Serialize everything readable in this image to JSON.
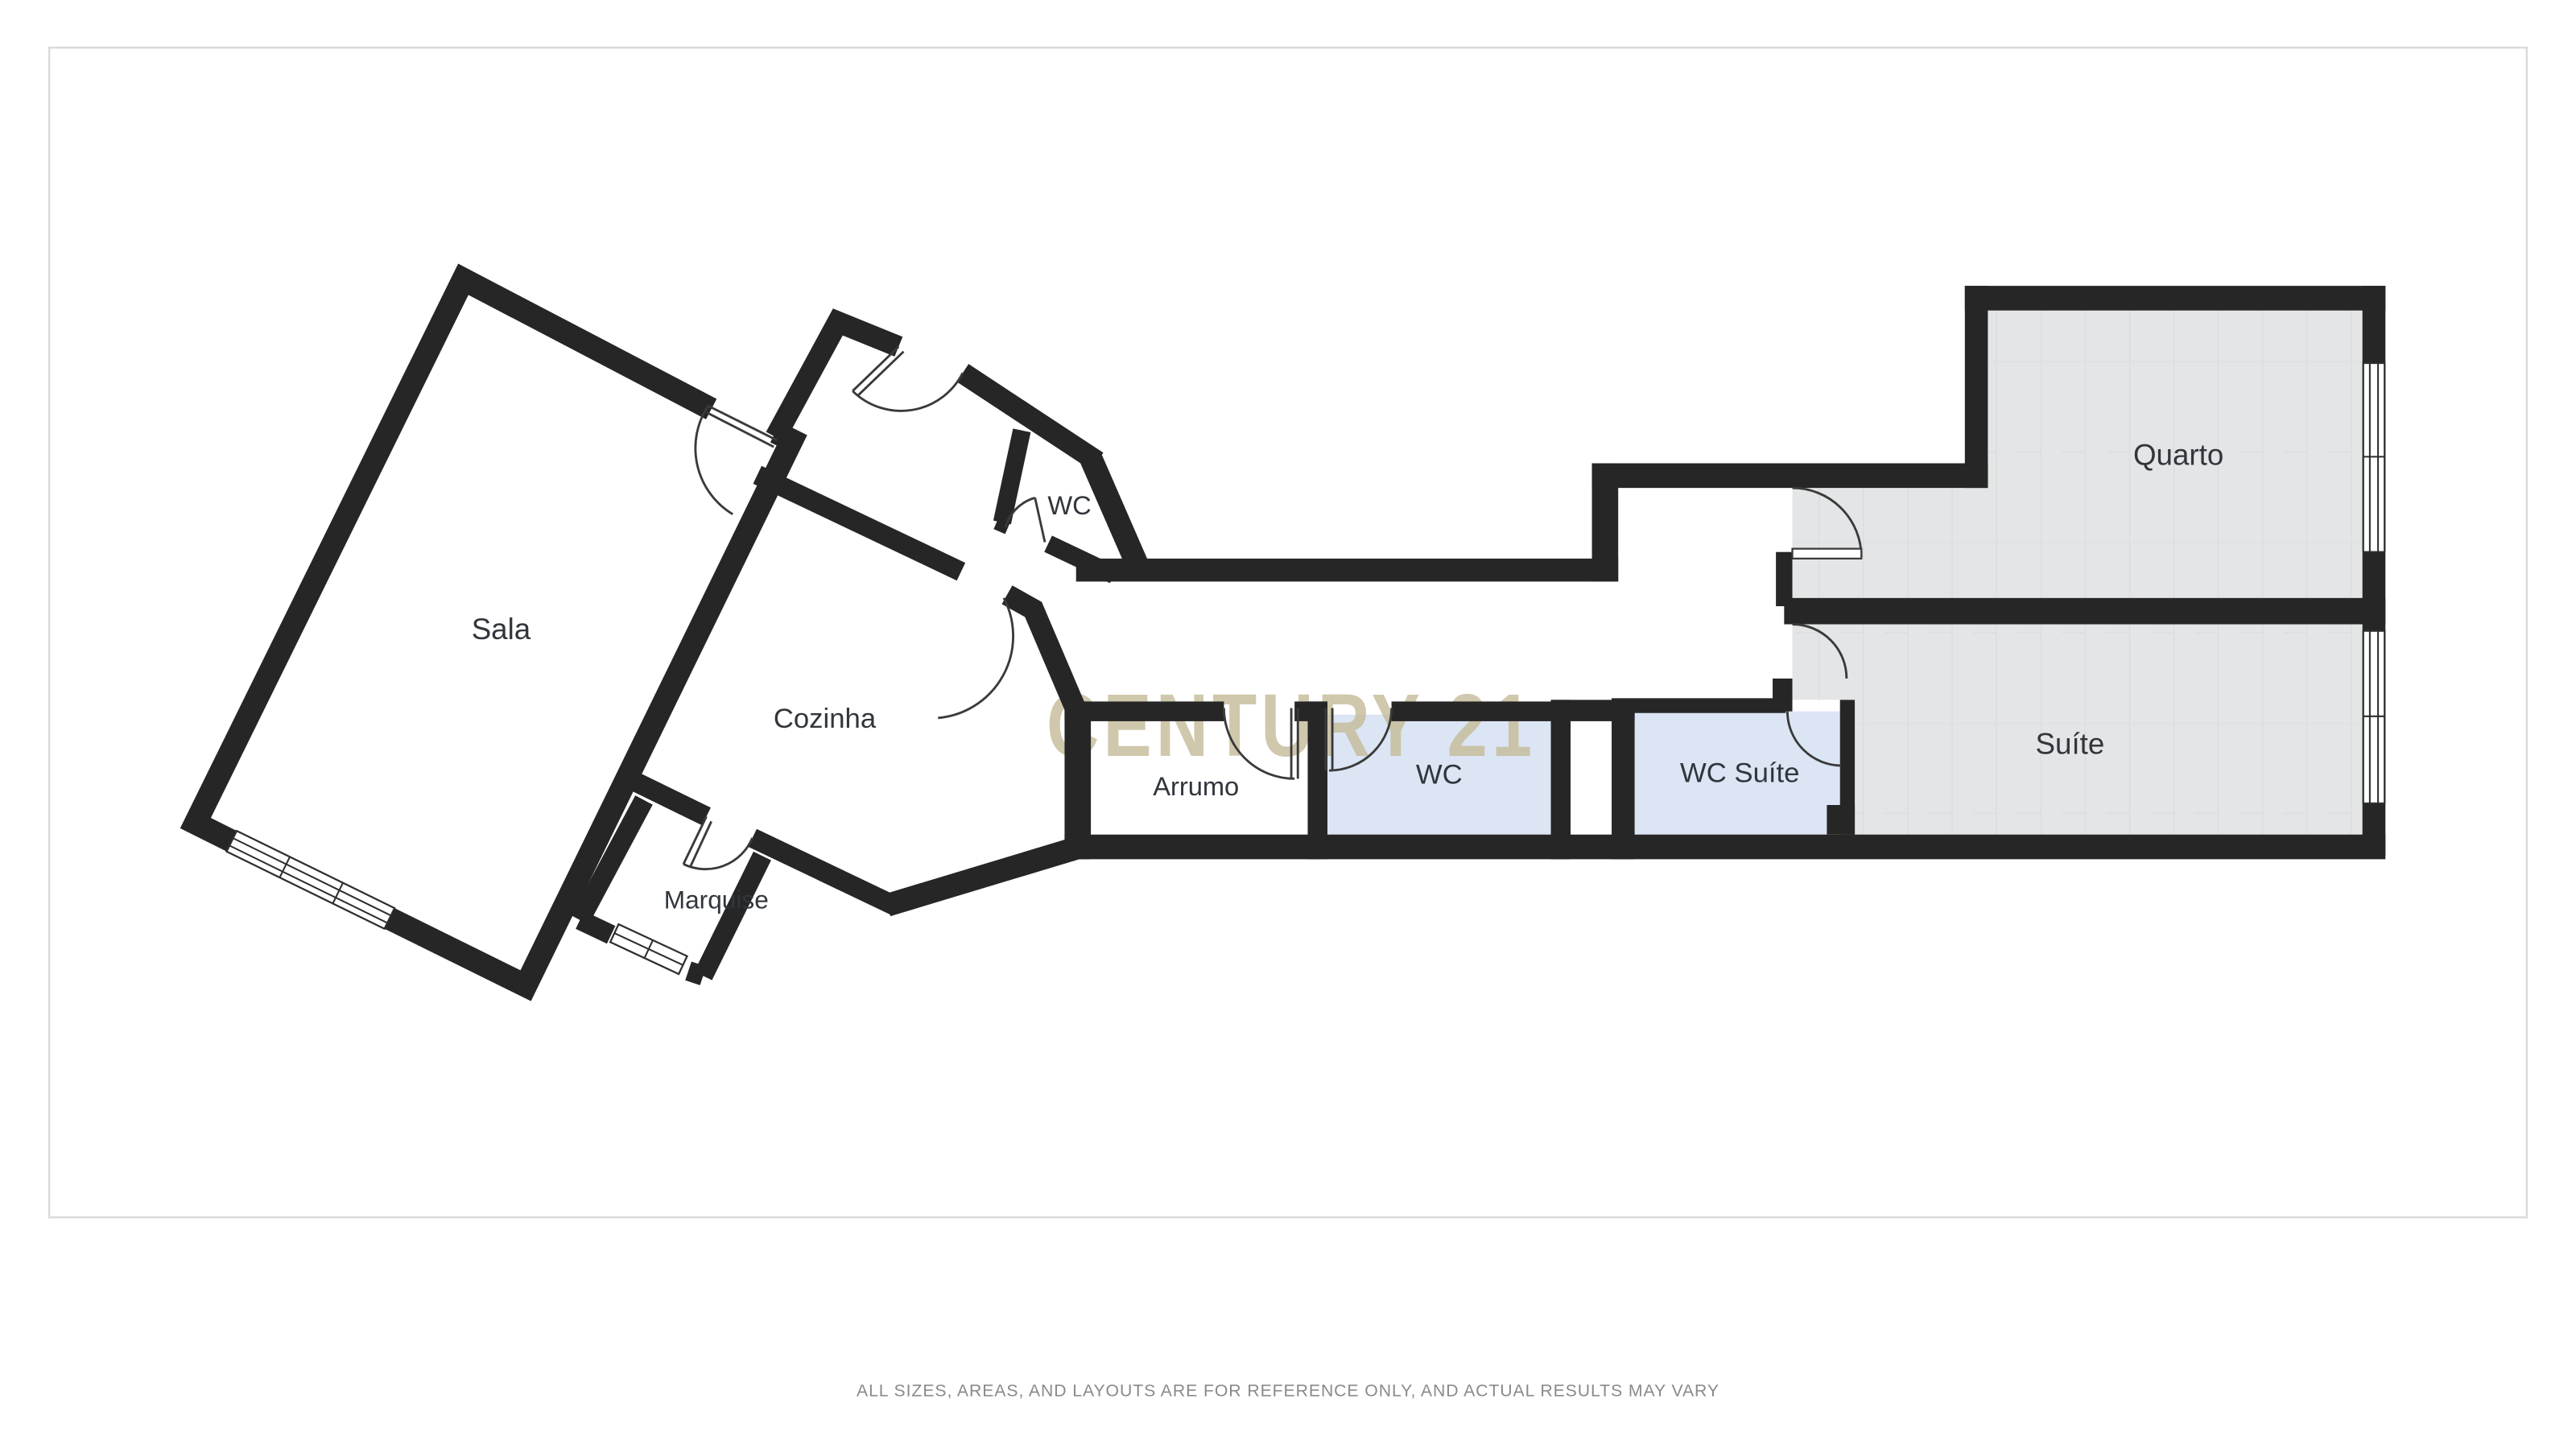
{
  "floor_plan": {
    "rooms": {
      "sala": {
        "label": "Sala"
      },
      "cozinha": {
        "label": "Cozinha"
      },
      "wc_hall": {
        "label": "WC"
      },
      "marquise": {
        "label": "Marquise"
      },
      "arrumo": {
        "label": "Arrumo"
      },
      "wc": {
        "label": "WC"
      },
      "wc_suite": {
        "label": "WC Suíte"
      },
      "suite": {
        "label": "Suíte"
      },
      "quarto": {
        "label": "Quarto"
      }
    },
    "watermark": {
      "text": "CENTURY 21",
      "color": "#c5bb98"
    },
    "disclaimer": {
      "text": "ALL SIZES, AREAS, AND LAYOUTS ARE FOR REFERENCE ONLY, AND ACTUAL RESULTS MAY VARY",
      "color": "#8a8a8a"
    },
    "colors": {
      "wall": "#262626",
      "floor_white": "#ffffff",
      "floor_blue": "#dbe5f4",
      "floor_gray": "#e4e5e6",
      "label": "#30363c",
      "frame_border": "#dadada"
    }
  }
}
